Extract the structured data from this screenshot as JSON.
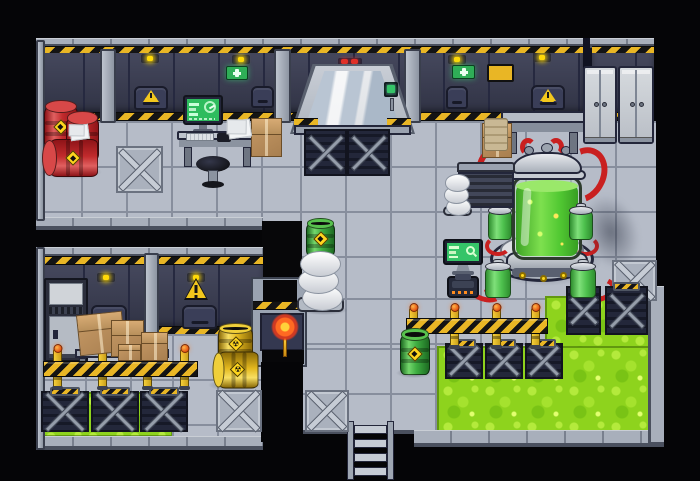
{
  "meta": {
    "scene": "sci-fi-laboratory-tilemap",
    "width": 700,
    "height": 481
  },
  "palette": {
    "background": "#050507",
    "floor": "#b6bcc8",
    "floor_grout": "#878e9d",
    "wall": "#3b3e54",
    "hazard_yellow": "#e9b625",
    "acid": "#8ed31d",
    "acid_light": "#b4ea3c",
    "barrel_red": "#c12a2c",
    "barrel_yellow": "#e3b81e",
    "barrel_green": "#3fae42",
    "reactor_liquid": "#58cb36",
    "metal_light": "#c6cbd2",
    "screen_green": "#35c468",
    "exit_green": "#2fae57",
    "light_yellow": "#ffd908"
  },
  "inventory": {
    "red_barrels": 3,
    "yellow_barrels": 2,
    "green_barrels": 2,
    "reactor_canisters": 4,
    "lockers": 2,
    "cardboard_boxes": 6,
    "barricade_posts": 8,
    "barricade_tapes": 2,
    "wall_hatches": 6,
    "exit_signs": 2,
    "ceiling_lights": 6,
    "x_panels": 4,
    "floor_grates": 10
  },
  "items": [
    {
      "type": "shadow",
      "name": "barrel-shadow",
      "x": 40,
      "y": 165,
      "w": 62,
      "h": 14
    },
    {
      "type": "shadow",
      "name": "barrel-shadow",
      "x": 208,
      "y": 379,
      "w": 54,
      "h": 12
    },
    {
      "type": "shadow",
      "name": "barrel-shadow",
      "x": 396,
      "y": 368,
      "w": 36,
      "h": 10
    },
    {
      "type": "shadow",
      "name": "reactor-shadow",
      "x": 584,
      "y": 194,
      "w": 54,
      "h": 76,
      "soft": true,
      "rot": -18
    },
    {
      "type": "shadow",
      "name": "fan-shadow",
      "x": 300,
      "y": 305,
      "w": 48,
      "h": 10
    },
    {
      "type": "ceiling-light",
      "name": "ceiling-light",
      "x": 141,
      "y": 54,
      "w": 18,
      "h": 9
    },
    {
      "type": "ceiling-light",
      "name": "ceiling-light",
      "x": 232,
      "y": 55,
      "w": 18,
      "h": 9
    },
    {
      "type": "ceiling-light",
      "name": "ceiling-light",
      "x": 448,
      "y": 55,
      "w": 18,
      "h": 9
    },
    {
      "type": "ceiling-light",
      "name": "ceiling-light",
      "x": 533,
      "y": 53,
      "w": 18,
      "h": 9
    },
    {
      "type": "ceiling-light",
      "name": "ceiling-light",
      "x": 97,
      "y": 273,
      "w": 18,
      "h": 9
    },
    {
      "type": "ceiling-light",
      "name": "ceiling-light",
      "x": 187,
      "y": 273,
      "w": 18,
      "h": 9
    },
    {
      "type": "exit-sign",
      "name": "exit-sign",
      "x": 226,
      "y": 66,
      "w": 22,
      "h": 14
    },
    {
      "type": "exit-sign",
      "name": "exit-sign",
      "x": 452,
      "y": 65,
      "w": 23,
      "h": 14
    },
    {
      "type": "caution-sign",
      "name": "caution-sign",
      "x": 487,
      "y": 64,
      "w": 27,
      "h": 18
    },
    {
      "type": "hatch",
      "name": "wall-hatch-warning",
      "x": 134,
      "y": 86,
      "w": 34,
      "h": 24,
      "warning": true
    },
    {
      "type": "hatch",
      "name": "wall-hatch-warning",
      "x": 531,
      "y": 85,
      "w": 34,
      "h": 25,
      "warning": true
    },
    {
      "type": "hatch",
      "name": "wall-hatch",
      "x": 251,
      "y": 86,
      "w": 23,
      "h": 22
    },
    {
      "type": "hatch",
      "name": "wall-hatch",
      "x": 446,
      "y": 86,
      "w": 22,
      "h": 23
    },
    {
      "type": "hatch",
      "name": "wall-hatch",
      "x": 91,
      "y": 305,
      "w": 36,
      "h": 24
    },
    {
      "type": "hatch",
      "name": "wall-hatch",
      "x": 182,
      "y": 305,
      "w": 35,
      "h": 24
    },
    {
      "type": "warn-triangle",
      "name": "warning-triangle-sign",
      "x": 184,
      "y": 278,
      "w": 24,
      "h": 22
    },
    {
      "type": "xpanel",
      "name": "floor-x-panel",
      "x": 116,
      "y": 146,
      "w": 47,
      "h": 47
    },
    {
      "type": "xpanel",
      "name": "floor-x-panel",
      "x": 612,
      "y": 260,
      "w": 45,
      "h": 41
    },
    {
      "type": "xpanel",
      "name": "floor-x-panel",
      "x": 216,
      "y": 390,
      "w": 46,
      "h": 42
    },
    {
      "type": "xpanel",
      "name": "floor-x-panel",
      "x": 305,
      "y": 390,
      "w": 44,
      "h": 42
    },
    {
      "type": "grate",
      "name": "vent-grate",
      "x": 304,
      "y": 129,
      "w": 43,
      "h": 47,
      "plate": false
    },
    {
      "type": "grate",
      "name": "vent-grate",
      "x": 347,
      "y": 129,
      "w": 43,
      "h": 47,
      "plate": false
    },
    {
      "type": "grate",
      "name": "acid-edge-grate",
      "x": 566,
      "y": 286,
      "w": 35,
      "h": 49,
      "plate": true
    },
    {
      "type": "grate",
      "name": "acid-edge-grate",
      "x": 605,
      "y": 286,
      "w": 43,
      "h": 49,
      "plate": true
    },
    {
      "type": "grate",
      "name": "acid-edge-grate",
      "x": 445,
      "y": 343,
      "w": 38,
      "h": 36,
      "plate": true
    },
    {
      "type": "grate",
      "name": "acid-edge-grate",
      "x": 485,
      "y": 343,
      "w": 38,
      "h": 36,
      "plate": true
    },
    {
      "type": "grate",
      "name": "acid-edge-grate",
      "x": 525,
      "y": 343,
      "w": 38,
      "h": 36,
      "plate": true
    },
    {
      "type": "grate",
      "name": "acid-edge-grate",
      "x": 41,
      "y": 391,
      "w": 48,
      "h": 41,
      "plate": true
    },
    {
      "type": "grate",
      "name": "acid-edge-grate",
      "x": 91,
      "y": 391,
      "w": 48,
      "h": 41,
      "plate": true
    },
    {
      "type": "grate",
      "name": "acid-edge-grate",
      "x": 140,
      "y": 391,
      "w": 48,
      "h": 41,
      "plate": true
    },
    {
      "type": "post",
      "name": "barricade-post",
      "x": 53,
      "y": 349,
      "w": 9,
      "h": 40
    },
    {
      "type": "post",
      "name": "barricade-post",
      "x": 98,
      "y": 349,
      "w": 9,
      "h": 40
    },
    {
      "type": "post",
      "name": "barricade-post",
      "x": 143,
      "y": 349,
      "w": 9,
      "h": 40
    },
    {
      "type": "post",
      "name": "barricade-post",
      "x": 180,
      "y": 349,
      "w": 9,
      "h": 40
    },
    {
      "type": "post",
      "name": "barricade-post",
      "x": 409,
      "y": 308,
      "w": 9,
      "h": 40
    },
    {
      "type": "post",
      "name": "barricade-post",
      "x": 450,
      "y": 308,
      "w": 9,
      "h": 40
    },
    {
      "type": "post",
      "name": "barricade-post",
      "x": 492,
      "y": 308,
      "w": 9,
      "h": 40
    },
    {
      "type": "post",
      "name": "barricade-post",
      "x": 531,
      "y": 308,
      "w": 9,
      "h": 40
    },
    {
      "type": "tape",
      "name": "barricade-tape",
      "x": 43,
      "y": 361,
      "w": 155,
      "h": 16
    },
    {
      "type": "tape",
      "name": "barricade-tape",
      "x": 406,
      "y": 318,
      "w": 142,
      "h": 16
    },
    {
      "type": "barrel",
      "variant": "red",
      "name": "red-barrel",
      "x": 44,
      "y": 100,
      "w": 34,
      "h": 49
    },
    {
      "type": "barrel",
      "variant": "red",
      "name": "red-barrel",
      "x": 66,
      "y": 111,
      "w": 33,
      "h": 50
    },
    {
      "type": "barrel",
      "variant": "red",
      "name": "red-barrel-lying",
      "x": 42,
      "y": 139,
      "w": 56,
      "h": 38,
      "lying": true
    },
    {
      "type": "barrel",
      "variant": "yellow",
      "name": "radioactive-barrel",
      "x": 218,
      "y": 323,
      "w": 35,
      "h": 39,
      "open": true
    },
    {
      "type": "barrel",
      "variant": "yellow",
      "name": "radioactive-barrel-lying",
      "x": 212,
      "y": 351,
      "w": 46,
      "h": 37,
      "lying": true
    },
    {
      "type": "barrel",
      "variant": "green",
      "name": "toxic-barrel",
      "x": 306,
      "y": 218,
      "w": 29,
      "h": 39,
      "open": true
    },
    {
      "type": "barrel",
      "variant": "green",
      "name": "toxic-barrel",
      "x": 400,
      "y": 328,
      "w": 30,
      "h": 47,
      "open": true
    },
    {
      "type": "canister",
      "name": "reactor-canister",
      "x": 487,
      "y": 203,
      "w": 26,
      "h": 37
    },
    {
      "type": "canister",
      "name": "reactor-canister",
      "x": 568,
      "y": 203,
      "w": 26,
      "h": 37
    },
    {
      "type": "canister",
      "name": "reactor-canister",
      "x": 484,
      "y": 259,
      "w": 28,
      "h": 39
    },
    {
      "type": "canister",
      "name": "reactor-canister",
      "x": 569,
      "y": 259,
      "w": 28,
      "h": 39
    },
    {
      "type": "machine",
      "name": "generator-machine",
      "x": 457,
      "y": 162,
      "w": 58,
      "h": 46
    },
    {
      "type": "fan",
      "name": "coil-duct",
      "x": 443,
      "y": 174,
      "w": 29,
      "h": 42
    },
    {
      "type": "fan",
      "name": "coil-duct",
      "x": 297,
      "y": 250,
      "w": 47,
      "h": 62
    },
    {
      "type": "box",
      "name": "cardboard-box",
      "x": 78,
      "y": 313,
      "w": 46,
      "h": 41,
      "rot": -6
    },
    {
      "type": "box",
      "name": "cardboard-box",
      "x": 111,
      "y": 320,
      "w": 33,
      "h": 37
    },
    {
      "type": "box",
      "name": "cardboard-box",
      "x": 141,
      "y": 332,
      "w": 27,
      "h": 29
    },
    {
      "type": "box",
      "name": "cardboard-box",
      "x": 118,
      "y": 344,
      "w": 23,
      "h": 17
    },
    {
      "type": "box",
      "name": "cardboard-box",
      "x": 251,
      "y": 118,
      "w": 31,
      "h": 39
    },
    {
      "type": "box",
      "name": "cardboard-box",
      "x": 482,
      "y": 123,
      "w": 30,
      "h": 35
    },
    {
      "type": "paper",
      "name": "papers",
      "x": 228,
      "y": 120,
      "w": 23,
      "h": 18
    },
    {
      "type": "paper",
      "name": "papers",
      "x": 70,
      "y": 125,
      "w": 19,
      "h": 15
    },
    {
      "type": "cloth",
      "name": "cloth",
      "x": 484,
      "y": 118,
      "w": 24,
      "h": 33
    },
    {
      "type": "locker",
      "name": "locker-cabinet",
      "x": 583,
      "y": 66,
      "w": 34,
      "h": 78
    },
    {
      "type": "locker",
      "name": "locker-cabinet",
      "x": 618,
      "y": 66,
      "w": 36,
      "h": 78
    },
    {
      "type": "torch",
      "name": "wall-torch",
      "x": 269,
      "y": 313,
      "w": 31,
      "h": 47
    },
    {
      "type": "door-button",
      "name": "door-button",
      "x": 384,
      "y": 82,
      "w": 15,
      "h": 29
    }
  ]
}
